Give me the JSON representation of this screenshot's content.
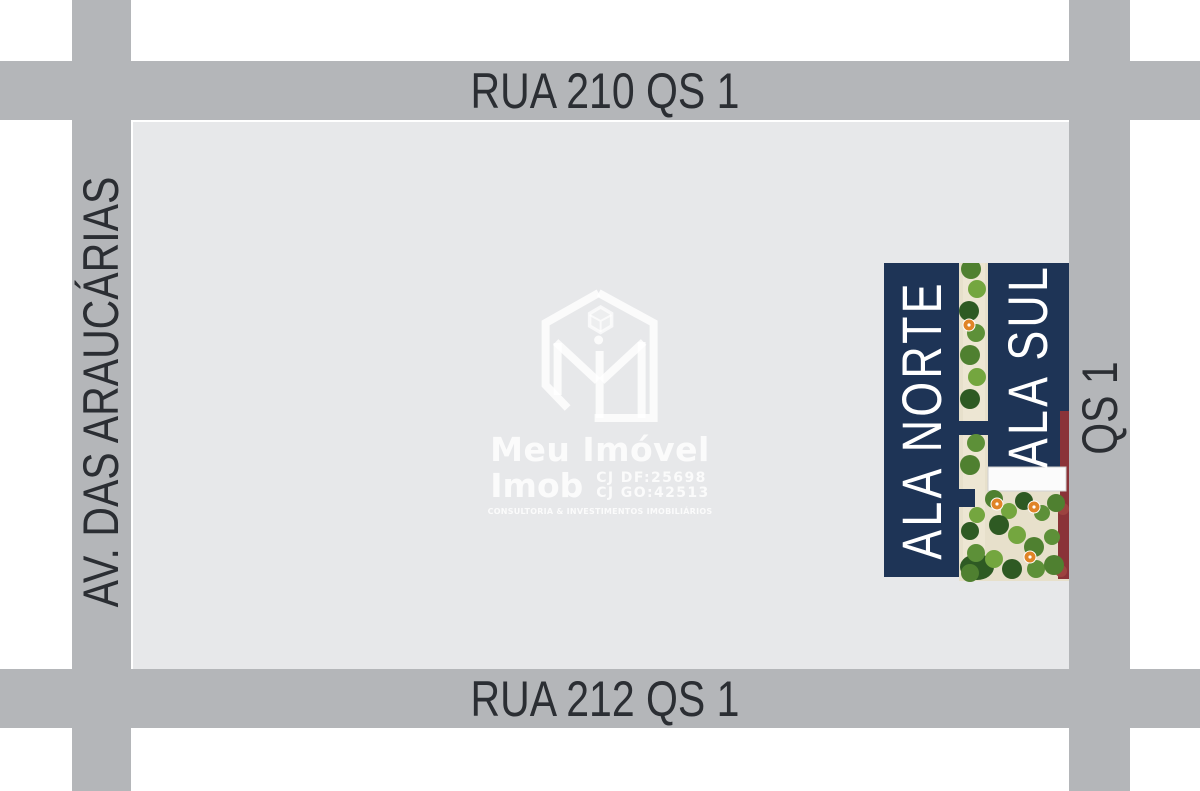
{
  "streets": {
    "top": {
      "name": "RUA 210 QS 1"
    },
    "bottom": {
      "name": "RUA 212 QS 1"
    },
    "left": {
      "name": "AV. DAS ARAUCÁRIAS"
    },
    "right": {
      "name": "QS 1"
    }
  },
  "site_plan": {
    "north_wing_label": "ALA NORTE",
    "south_wing_label": "ALA SUL"
  },
  "watermark": {
    "logo_icon": "meu-imovel-hexagon-m-logo",
    "brand_name": "Meu Imóvel",
    "brand_suffix": "Imob",
    "registry_df": "CJ DF:25698",
    "registry_go": "CJ GO:42513",
    "tagline": "CONSULTORIA & INVESTIMENTOS IMOBILIÁRIOS"
  },
  "colors": {
    "street_gray": "#b4b6b9",
    "block_gray": "#e7e8ea",
    "street_text": "#2b2e33",
    "navy": "#1e3456",
    "plaza_beige": "#e7e0cb",
    "path_light": "#efe8d6",
    "pool_white": "#fbfbfb",
    "tree_green_dark": "#2e5a23",
    "tree_green": "#4f8030",
    "tree_green_light": "#74a63f",
    "tree_green_mid": "#5d9038",
    "umbrella_orange": "#e08427",
    "planter_maroon": "#8a3338",
    "watermark_white": "#ffffff"
  }
}
